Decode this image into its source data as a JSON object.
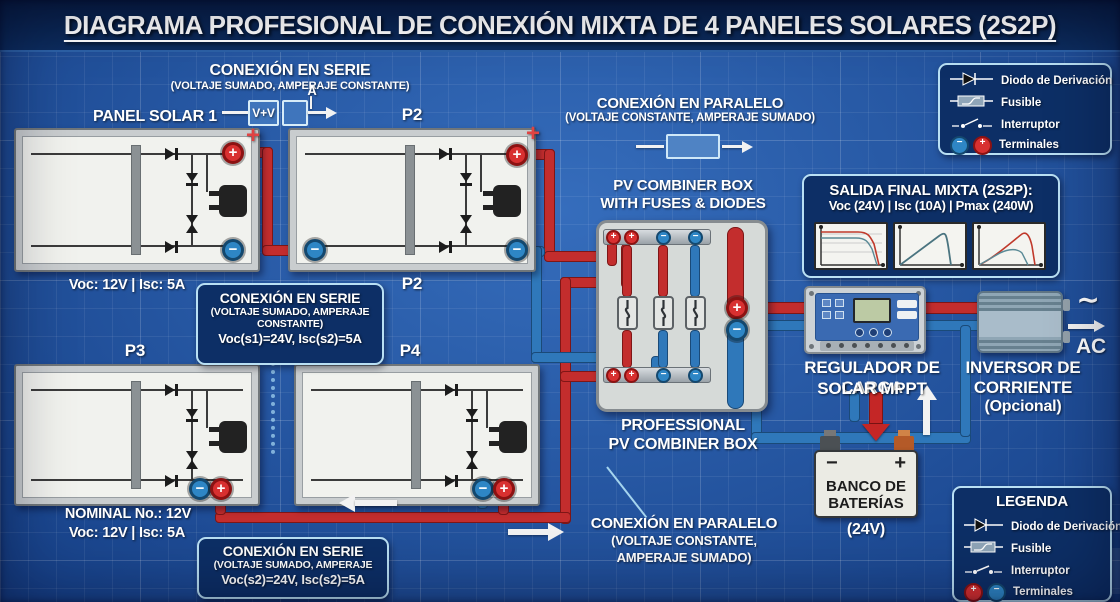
{
  "glyphs": {
    "plus": "+",
    "minus": "−",
    "tilde": "∼"
  },
  "title": "DIAGRAMA PROFESIONAL DE CONEXIÓN MIXTA DE 4 PANELES SOLARES (2S2P)",
  "series_top": {
    "heading": "CONEXIÓN EN SERIE",
    "sub": "(VOLTAJE SUMADO, AMPERAJE CONSTANTE)",
    "box_label": "V+V",
    "amp_label": "A"
  },
  "paralelo_top": {
    "heading": "CONEXIÓN EN PARALELO",
    "sub": "(VOLTAJE CONSTANTE, AMPERAJE SUMADO)"
  },
  "panels": {
    "p1": {
      "label": "PANEL SOLAR 1",
      "specs": "Voc: 12V | Isc: 5A"
    },
    "p2": {
      "label": "P2",
      "label_below": "P2"
    },
    "p3": {
      "label": "P3",
      "nominal": "NOMINAL No.: 12V",
      "specs": "Voc: 12V | Isc: 5A"
    },
    "p4": {
      "label": "P4"
    }
  },
  "series_box1": {
    "heading": "CONEXIÓN EN SERIE",
    "sub1": "(VOLTAJE SUMADO, AMPERAJE",
    "sub2": "CONSTANTE)",
    "value": "Voc(s1)=24V, Isc(s2)=5A"
  },
  "series_box2": {
    "heading": "CONEXIÓN EN SERIE",
    "sub1": "(VOLTAJE SUMADO, AMPERAJE",
    "value": "Voc(s2)=24V, Isc(s2)=5A"
  },
  "combiner": {
    "label_top1": "PV COMBINER BOX",
    "label_top2": "WITH FUSES & DIODES",
    "label_bottom1": "PROFESSIONAL",
    "label_bottom2": "PV COMBINER BOX"
  },
  "paralelo_bottom": {
    "heading": "CONEXIÓN EN PARALELO",
    "sub1": "(VOLTAJE CONSTANTE,",
    "sub2": "AMPERAJE SUMADO)"
  },
  "salida": {
    "title": "SALIDA FINAL MIXTA (2S2P):",
    "specs": "Voc (24V) | Isc (10A) | Pmax (240W)"
  },
  "regulador": {
    "line1": "REGULADOR DE CARGA",
    "line2": "SOLAR MPPT"
  },
  "inversor": {
    "line1": "INVERSOR DE",
    "line2": "CORRIENTE",
    "line3": "(Opcional)",
    "ac_label": "AC"
  },
  "bateria": {
    "line1": "BANCO DE",
    "line2": "BATERÍAS",
    "value": "(24V)"
  },
  "legend_top": {
    "items": [
      "Diodo de Derivación",
      "Fusible",
      "Interruptor",
      "Terminales"
    ]
  },
  "legend_bottom": {
    "title": "LEGENDA",
    "items": [
      "Diodo de Derivación",
      "Fusible",
      "Interruptor",
      "Terminales"
    ]
  },
  "colors": {
    "background": "#1d55a8",
    "wire_red": "#c32d2d",
    "wire_blue": "#2f78ba",
    "panel_face": "#f1f2ee",
    "info_box_bg": "#0d2f66",
    "info_box_border": "#b9e0f4"
  }
}
